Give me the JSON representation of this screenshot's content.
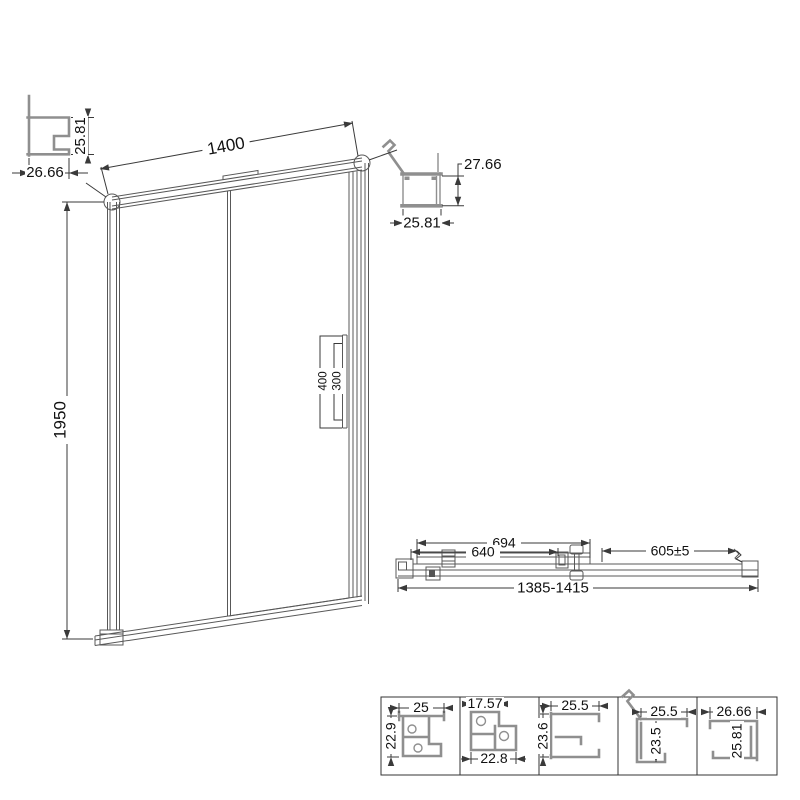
{
  "front_view": {
    "width": "1400",
    "height": "1950",
    "handle_outer_height": "400",
    "handle_inner_height": "300"
  },
  "top_left_profile": {
    "height": "25.81",
    "width": "26.66"
  },
  "top_right_profile": {
    "height": "27.66",
    "width": "25.81"
  },
  "plan_view": {
    "door_width": "694",
    "glass_width": "640",
    "fixed_panel_width": "605±5",
    "overall_width": "1385-1415"
  },
  "details": [
    {
      "top": "25",
      "side": "22.9"
    },
    {
      "top": "17.57",
      "bottom": "22.8"
    },
    {
      "top": "25.5",
      "side": "23.6"
    },
    {
      "top": "25.5",
      "side": "23.5"
    },
    {
      "top": "26.66",
      "side": "25.81"
    }
  ],
  "colors": {
    "background": "#ffffff",
    "line": "#4a4a4a",
    "profile": "#8f8f8f",
    "text": "#111111"
  }
}
